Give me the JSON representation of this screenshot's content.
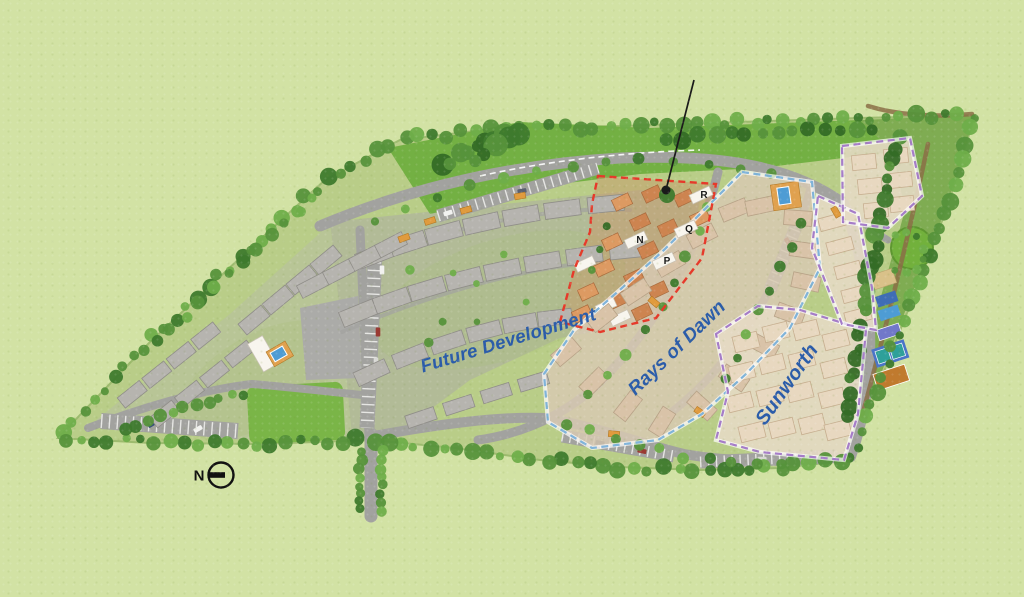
{
  "map": {
    "type": "residential-site-plan",
    "zone_labels": [
      {
        "id": "future-development",
        "label": "Future Development"
      },
      {
        "id": "rays-of-dawn",
        "label": "Rays of Dawn"
      },
      {
        "id": "sunworth",
        "label": "Sunworth"
      }
    ],
    "building_markers": [
      {
        "label": "N"
      },
      {
        "label": "P"
      },
      {
        "label": "Q"
      },
      {
        "label": "R"
      }
    ],
    "compass": {
      "label": "N"
    },
    "features": [
      "clubhouse-pool",
      "swimming-pool",
      "tennis-court",
      "basketball-court",
      "playground",
      "circular-lawn",
      "central-park",
      "tree-lined-boundary",
      "parking-bays",
      "location-pointer"
    ],
    "colors": {
      "grass": "#d2e2a4",
      "site": "#b9cd88",
      "road": "#a2a29f",
      "plaza": "#ababa8",
      "park_lawn": "#6fae3f",
      "lawn": "#7ab547",
      "gray_building": "#b6b4af",
      "gray_building_stroke": "#8f8d88",
      "phase_building": "#cd8450",
      "phase_building_alt": "#dd9a62",
      "white_building": "#f8f5ee",
      "rays_building": "#d9c3a8",
      "rays_building_stroke": "#b7a287",
      "sun_building": "#e8d8c0",
      "sun_building_stroke": "#c6ae8f",
      "outline_red": "#e6392a",
      "outline_blue": "#7fb3da",
      "outline_purple": "#a57cc8",
      "label": "#2b5ca9",
      "pool": "#4e9cd4",
      "pool_dark": "#3f6db5",
      "deck": "#e0a14f",
      "tennis": "#2ea09a",
      "court_blue": "#7178c9",
      "court_orange": "#c07a2e",
      "sand": "#d9c189",
      "tree_dark": "#3e7a2d",
      "tree_mid": "#56923b",
      "tree_light": "#6fae4a",
      "path_brown": "#8b6f46",
      "pointer": "#1a1a1a"
    }
  }
}
